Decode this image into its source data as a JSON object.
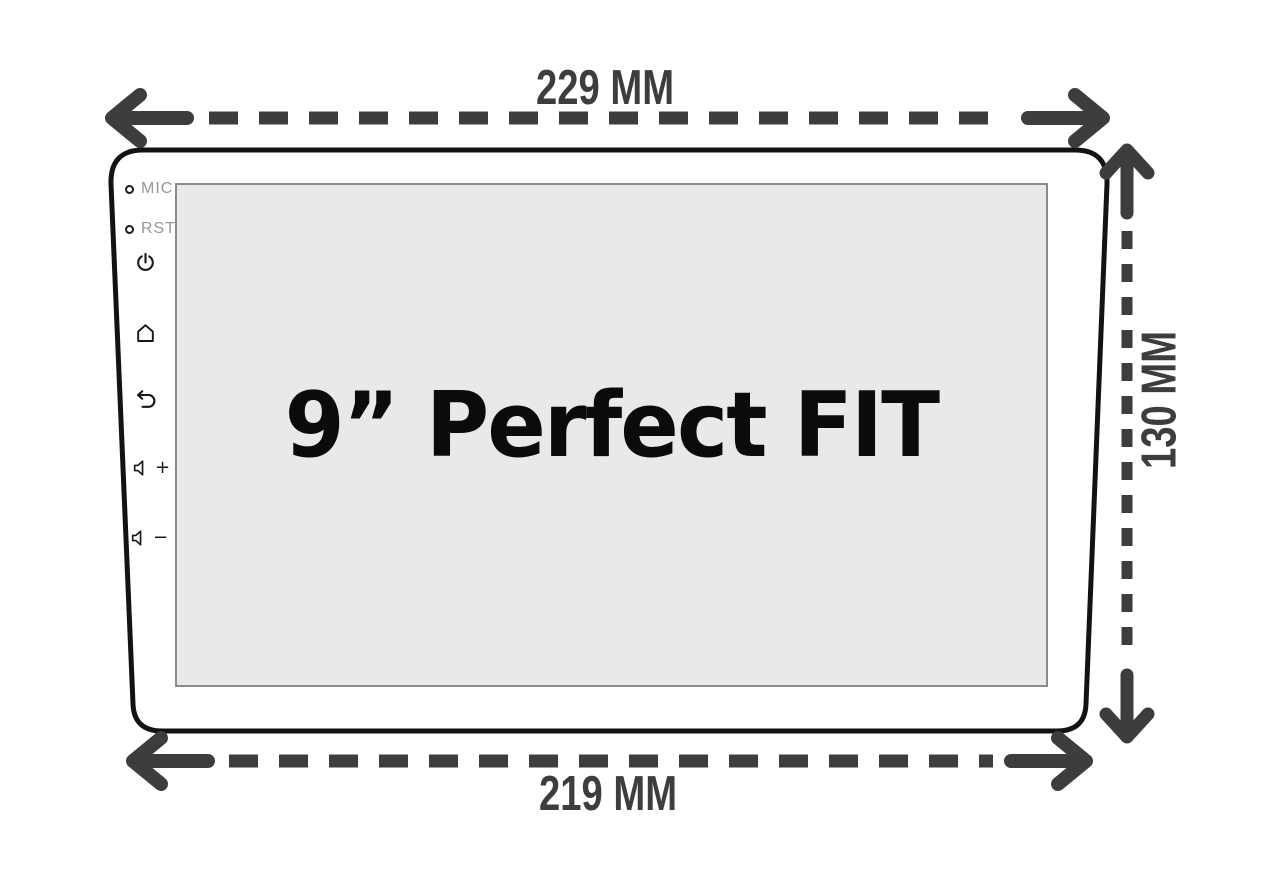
{
  "dimensions": {
    "top_width": "229 MM",
    "bottom_width": "219 MM",
    "side_height": "130 MM"
  },
  "screen": {
    "label": "9” Perfect FIT"
  },
  "controls": {
    "mic_label": "MIC",
    "rst_label": "RST",
    "volume_up_sign": "+",
    "volume_down_sign": "−"
  },
  "icons": {
    "power": "power-icon",
    "home": "home-icon",
    "back": "back-icon",
    "volume_up": "volume-up-icon",
    "volume_down": "volume-down-icon",
    "mic_hole": "mic-hole-icon",
    "reset_hole": "reset-hole-icon"
  },
  "colors": {
    "dimension_annotation": "#3d3d3d",
    "device_outline": "#131313",
    "screen_fill": "#e9e9e9",
    "screen_border": "#8a8a8a",
    "background": "#ffffff"
  }
}
